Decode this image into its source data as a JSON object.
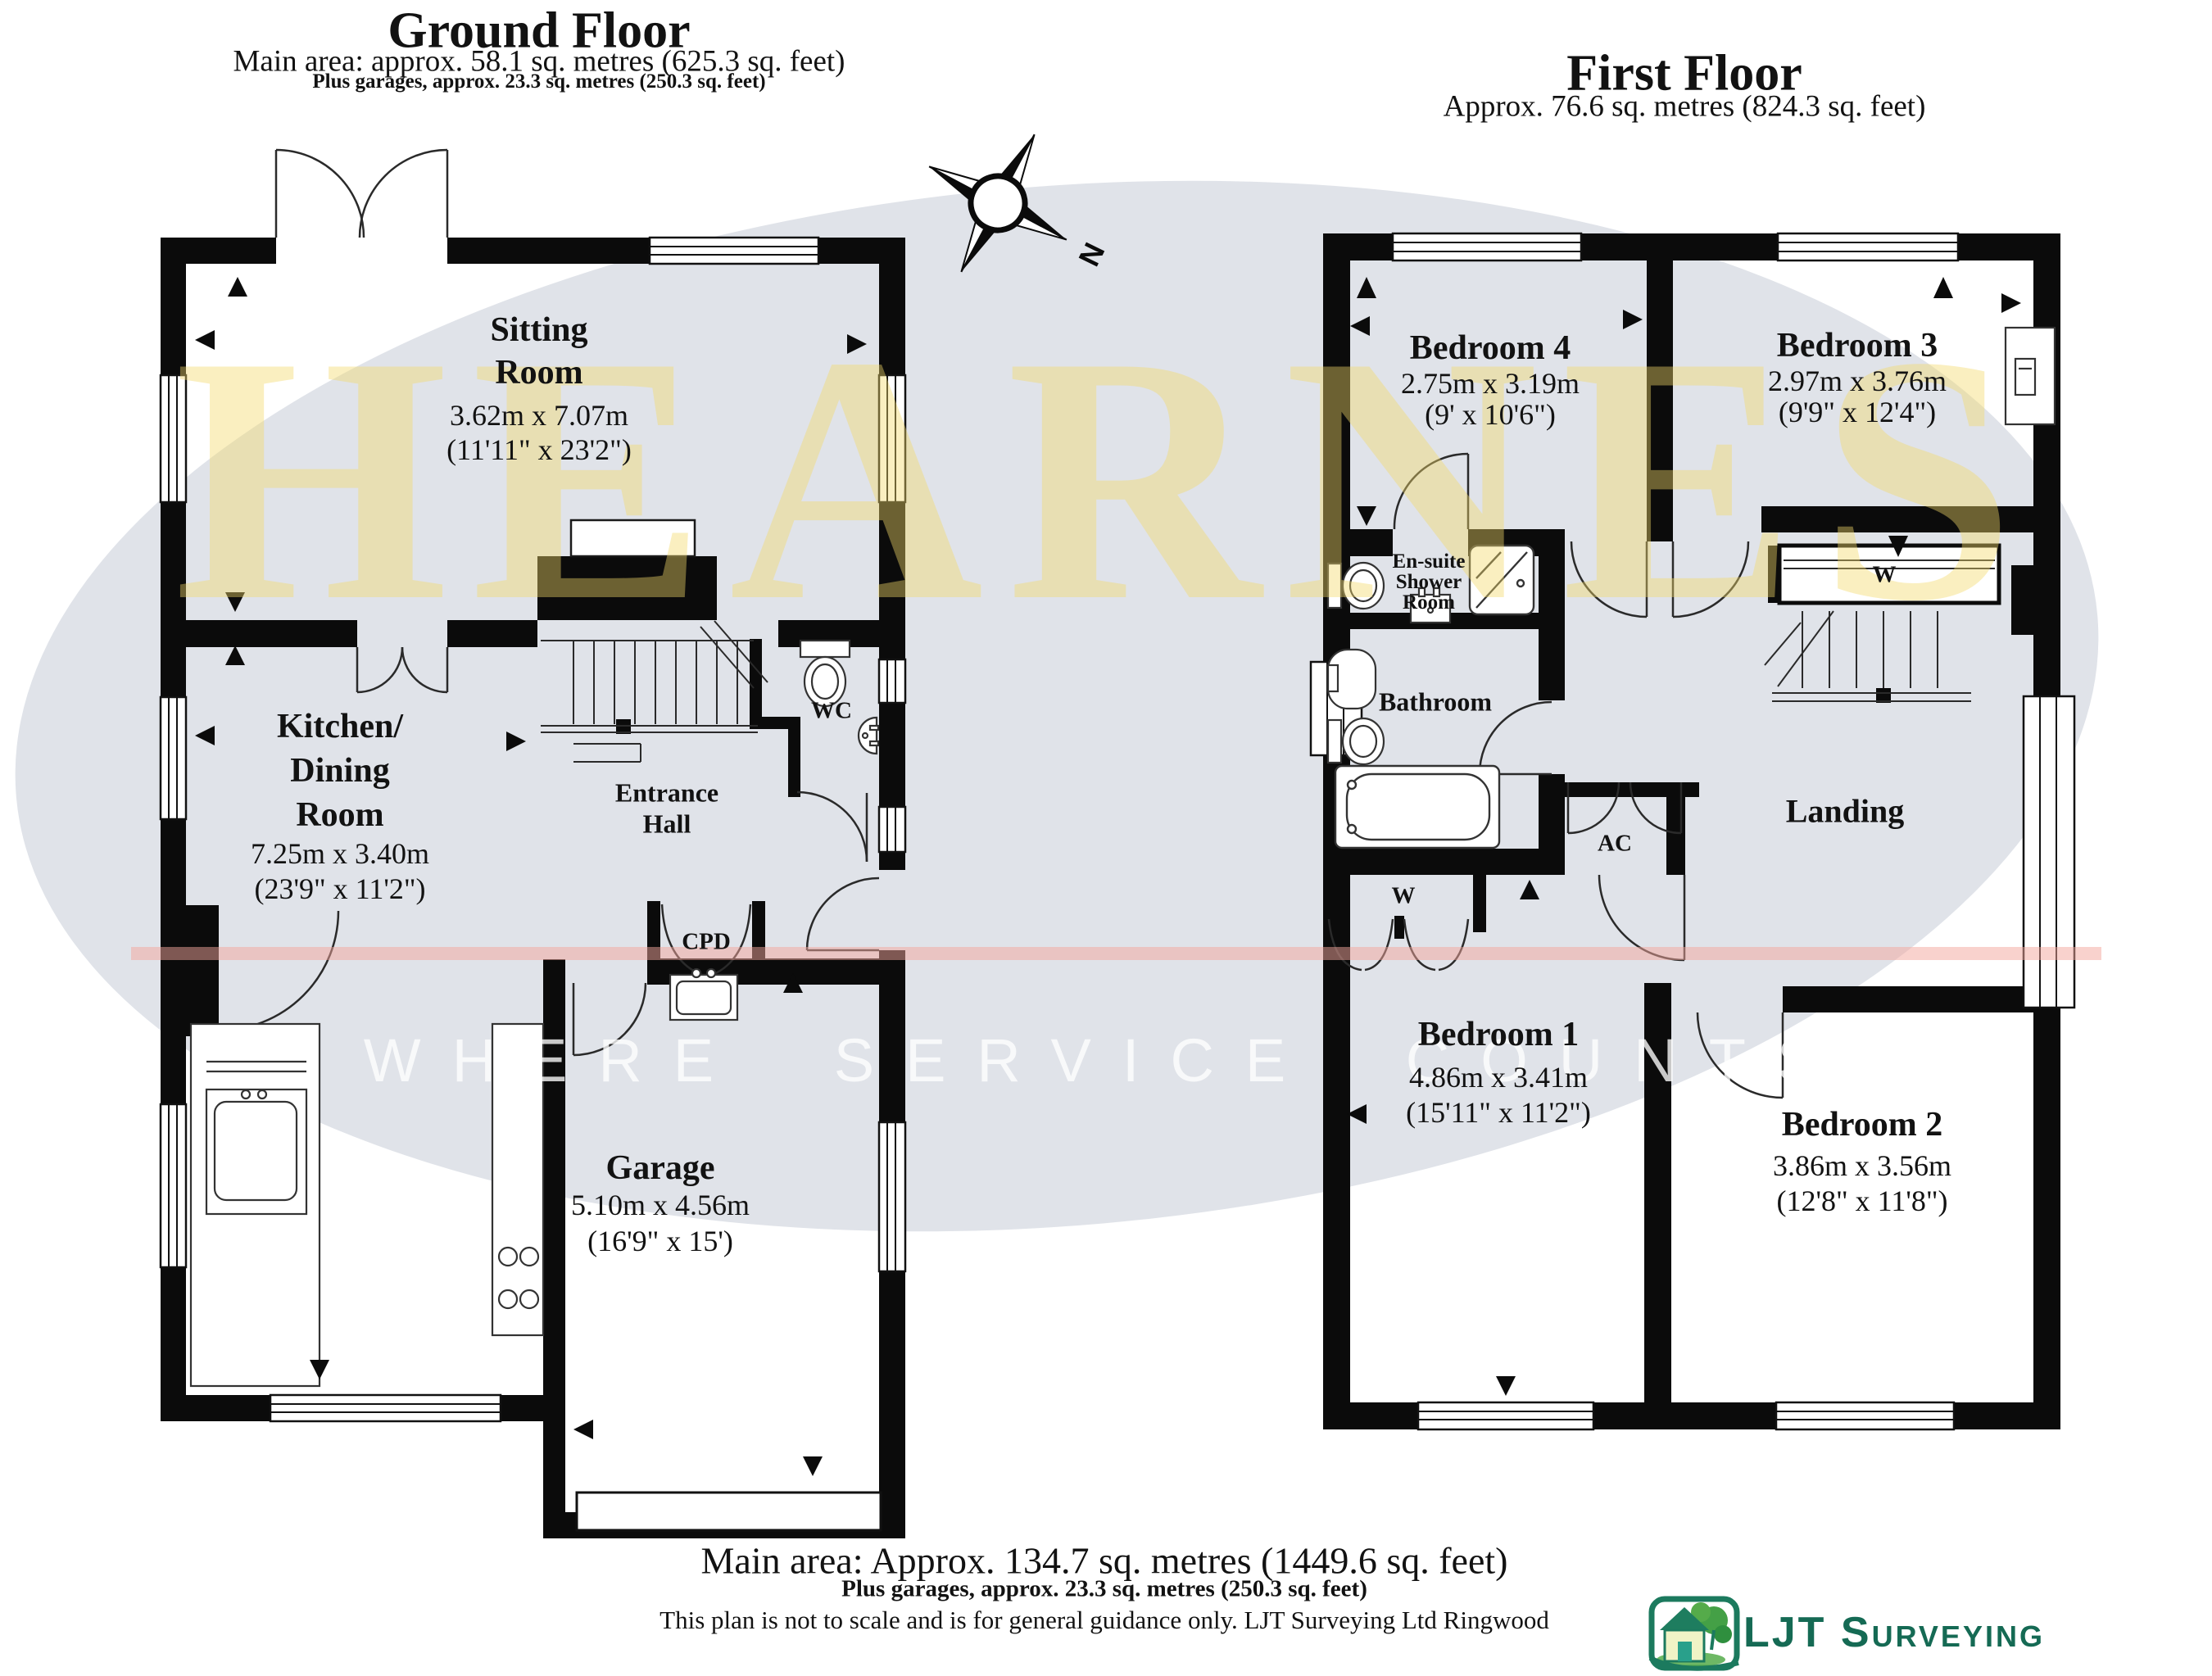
{
  "ground_floor": {
    "title": "Ground Floor",
    "area_line": "Main area: approx. 58.1 sq. metres (625.3 sq. feet)",
    "garage_line": "Plus garages, approx. 23.3 sq. metres (250.3 sq. feet)",
    "rooms": {
      "sitting": {
        "l1": "Sitting",
        "l2": "Room",
        "dims_m": "3.62m x 7.07m",
        "dims_ft": "(11'11\" x 23'2\")"
      },
      "kitchen": {
        "l1": "Kitchen/",
        "l2": "Dining",
        "l3": "Room",
        "dims_m": "7.25m x 3.40m",
        "dims_ft": "(23'9\" x 11'2\")"
      },
      "hall": {
        "l1": "Entrance",
        "l2": "Hall"
      },
      "wc": {
        "label": "WC"
      },
      "cpd": {
        "label": "CPD"
      },
      "garage": {
        "name": "Garage",
        "dims_m": "5.10m x 4.56m",
        "dims_ft": "(16'9\" x 15')"
      }
    }
  },
  "first_floor": {
    "title": "First Floor",
    "area_line": "Approx. 76.6 sq. metres (824.3 sq. feet)",
    "rooms": {
      "bedroom4": {
        "name": "Bedroom 4",
        "dims_m": "2.75m x 3.19m",
        "dims_ft": "(9' x 10'6\")"
      },
      "bedroom3": {
        "name": "Bedroom 3",
        "dims_m": "2.97m x 3.76m",
        "dims_ft": "(9'9\" x 12'4\")"
      },
      "ensuite": {
        "l1": "En-suite",
        "l2": "Shower",
        "l3": "Room"
      },
      "bathroom": {
        "label": "Bathroom"
      },
      "ac": {
        "label": "AC"
      },
      "wardrobe_bathroom": {
        "label": "W"
      },
      "wardrobe_landing": {
        "label": "W"
      },
      "landing": {
        "label": "Landing"
      },
      "bedroom1": {
        "name": "Bedroom 1",
        "dims_m": "4.86m x 3.41m",
        "dims_ft": "(15'11\" x 11'2\")"
      },
      "bedroom2": {
        "name": "Bedroom 2",
        "dims_m": "3.86m x 3.56m",
        "dims_ft": "(12'8\" x 11'8\")"
      }
    }
  },
  "footer": {
    "main_area": "Main area: Approx. 134.7 sq. metres (1449.6 sq. feet)",
    "garages": "Plus garages, approx. 23.3 sq. metres (250.3 sq. feet)",
    "disclaimer": "This plan is not to scale and is for general guidance only. LJT Surveying Ltd Ringwood"
  },
  "watermark": {
    "name": "HEARNES",
    "tagline": "WHERE SERVICE COUNTS"
  },
  "compass": {
    "north": "N"
  },
  "logo": {
    "text": "LJT Surveying"
  },
  "colors": {
    "wall": "#0b0b0b",
    "ellipse": "#e0e3e9",
    "watermark_yellow": "#f2d869",
    "pink_line": "#f4a69b",
    "logo_teal": "#156a54"
  }
}
